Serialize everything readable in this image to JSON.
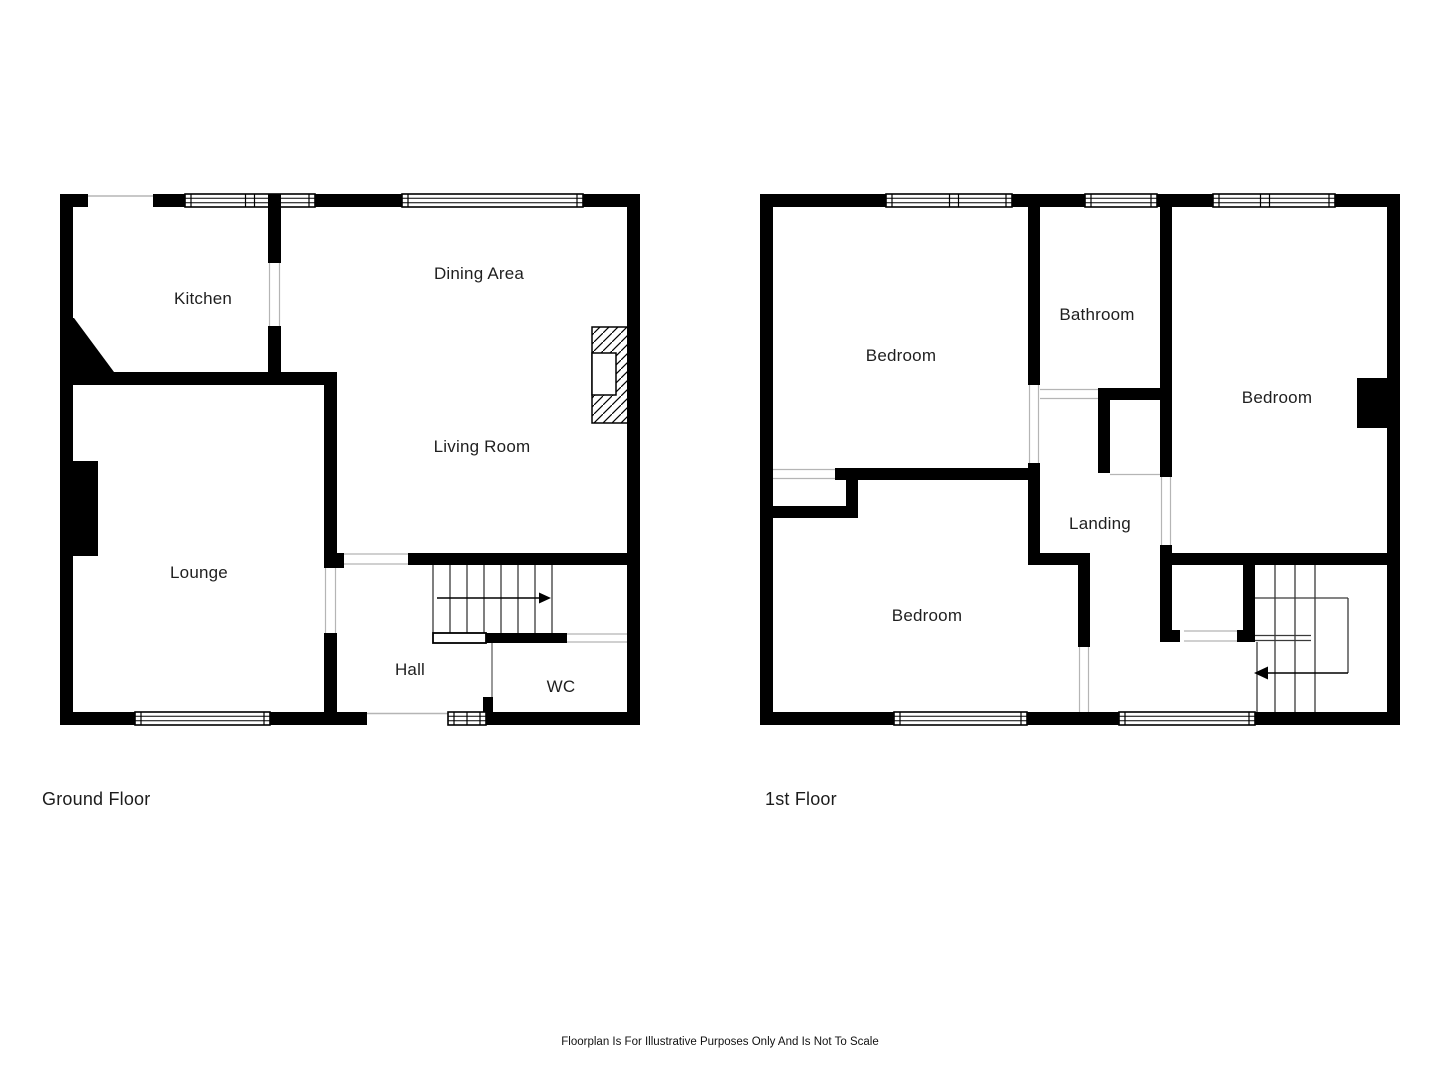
{
  "page": {
    "footer": "Floorplan Is For Illustrative Purposes Only And Is Not To Scale"
  },
  "floors": [
    {
      "title": "Ground Floor",
      "rooms": [
        "Kitchen",
        "Dining Area",
        "Living Room",
        "Lounge",
        "Hall",
        "WC"
      ],
      "features": [
        "double-window-top",
        "wide-window-top",
        "lounge-window-bottom",
        "small-window-bottom",
        "front-door-opening",
        "staircase-up-arrow",
        "fireplace-hatched",
        "chimney-breast-left"
      ]
    },
    {
      "title": "1st Floor",
      "rooms": [
        "Bedroom",
        "Bathroom",
        "Bedroom",
        "Landing",
        "Bedroom"
      ],
      "features": [
        "three-windows-top",
        "two-windows-bottom",
        "staircase-down-arrow",
        "chimney-breast-right",
        "landing-cupboard"
      ]
    }
  ],
  "colors": {
    "wall": "#000000",
    "background": "#ffffff",
    "label_text": "#1f1f1f",
    "stair_line": "#3a3a3a",
    "opening_line": "#b5b5b5"
  }
}
